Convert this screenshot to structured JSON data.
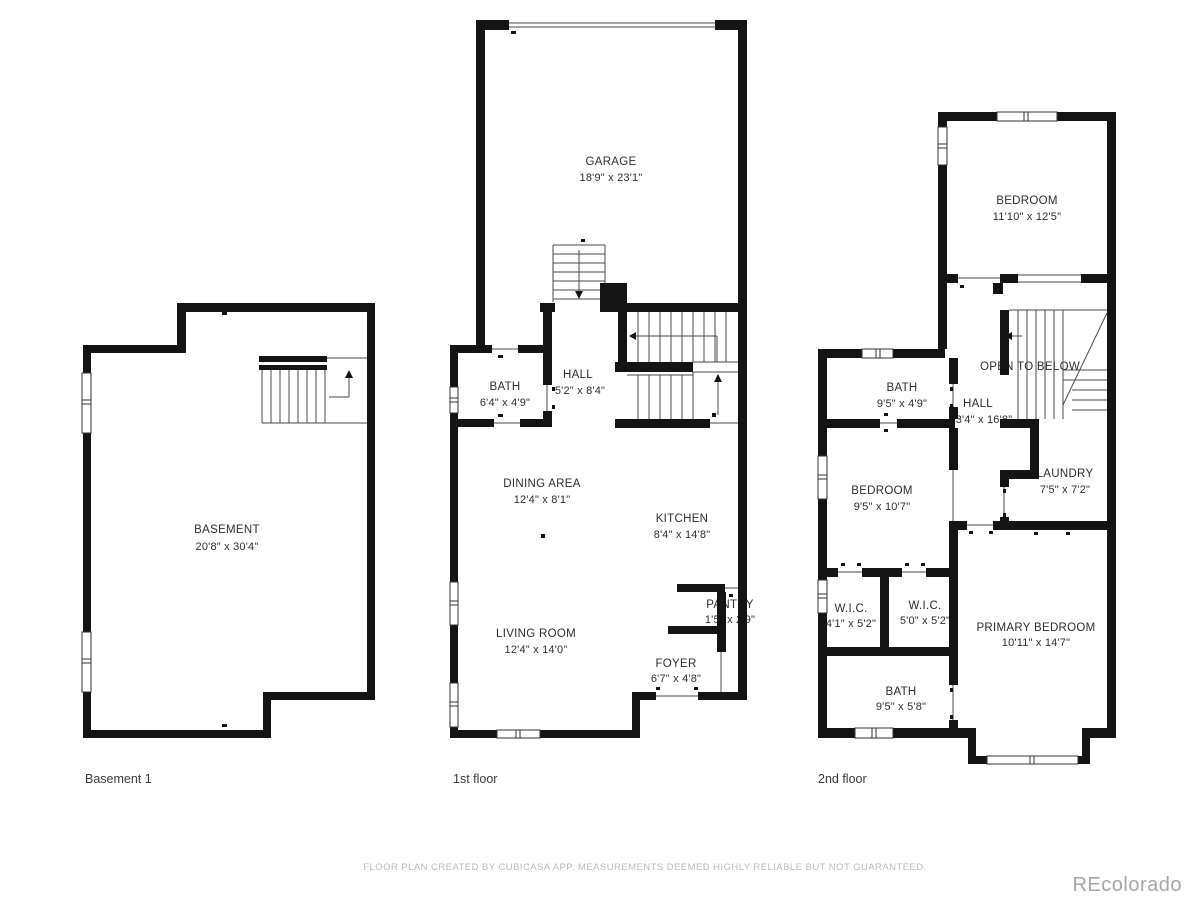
{
  "footer": {
    "disclaimer": "FLOOR PLAN CREATED BY CUBICASA APP. MEASUREMENTS DEEMED HIGHLY RELIABLE BUT NOT GUARANTEED."
  },
  "watermark": "REcolorado",
  "colors": {
    "wall": "#141414",
    "line": "#4a4a4a",
    "text": "#2d2d2d",
    "muted": "#b9b9b9",
    "watermark": "#a6a6a6",
    "background": "#ffffff"
  },
  "floors": {
    "basement": {
      "name": "Basement 1",
      "rooms": {
        "basement": {
          "label": "BASEMENT",
          "dims": "20'8\" x 30'4\""
        }
      }
    },
    "first": {
      "name": "1st floor",
      "rooms": {
        "garage": {
          "label": "GARAGE",
          "dims": "18'9\" x 23'1\""
        },
        "bath": {
          "label": "BATH",
          "dims": "6'4\" x 4'9\""
        },
        "hall": {
          "label": "HALL",
          "dims": "5'2\" x 8'4\""
        },
        "dining": {
          "label": "DINING AREA",
          "dims": "12'4\" x 8'1\""
        },
        "kitchen": {
          "label": "KITCHEN",
          "dims": "8'4\" x 14'8\""
        },
        "pantry": {
          "label": "PANTRY",
          "dims": "1'5\" x 2'9\""
        },
        "living": {
          "label": "LIVING ROOM",
          "dims": "12'4\" x 14'0\""
        },
        "foyer": {
          "label": "FOYER",
          "dims": "6'7\" x 4'8\""
        }
      }
    },
    "second": {
      "name": "2nd floor",
      "annotation": "OPEN TO BELOW",
      "rooms": {
        "bedroom_top": {
          "label": "BEDROOM",
          "dims": "11'10\" x 12'5\""
        },
        "bath_top": {
          "label": "BATH",
          "dims": "9'5\" x 4'9\""
        },
        "hall": {
          "label": "HALL",
          "dims": "3'4\" x 16'8\""
        },
        "laundry": {
          "label": "LAUNDRY",
          "dims": "7'5\" x 7'2\""
        },
        "bedroom_left": {
          "label": "BEDROOM",
          "dims": "9'5\" x 10'7\""
        },
        "wic1": {
          "label": "W.I.C.",
          "dims": "4'1\" x 5'2\""
        },
        "wic2": {
          "label": "W.I.C.",
          "dims": "5'0\" x 5'2\""
        },
        "primary": {
          "label": "PRIMARY BEDROOM",
          "dims": "10'11\" x 14'7\""
        },
        "bath_bottom": {
          "label": "BATH",
          "dims": "9'5\" x 5'8\""
        }
      }
    }
  }
}
